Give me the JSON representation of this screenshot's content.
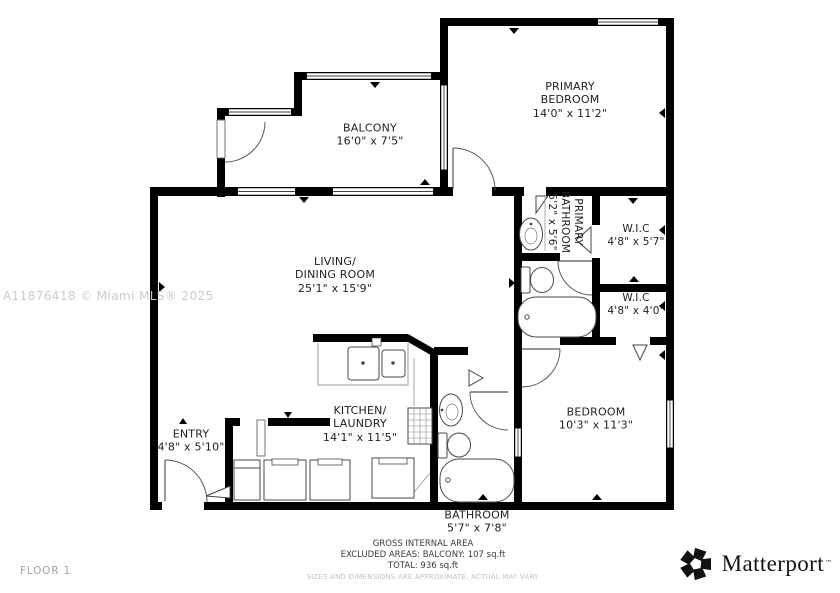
{
  "floorplan": {
    "rooms": [
      {
        "name": "PRIMARY\nBEDROOM",
        "dims": "14'0\" x 11'2\""
      },
      {
        "name": "BALCONY",
        "dims": "16'0\" x 7'5\""
      },
      {
        "name": "LIVING/\nDINING ROOM",
        "dims": "25'1\" x 15'9\""
      },
      {
        "name": "PRIMARY\nBATHROOM",
        "dims": "5'2\" x 5'6\""
      },
      {
        "name": "W.I.C",
        "dims": "4'8\" x 5'7\""
      },
      {
        "name": "W.I.C",
        "dims": "4'8\" x 4'0\""
      },
      {
        "name": "BEDROOM",
        "dims": "10'3\" x 11'3\""
      },
      {
        "name": "KITCHEN/\nLAUNDRY",
        "dims": "14'1\" x 11'5\""
      },
      {
        "name": "ENTRY",
        "dims": "4'8\" x 5'10\""
      },
      {
        "name": "BATHROOM",
        "dims": "5'7\" x 7'8\""
      }
    ],
    "floor_label": "FLOOR 1",
    "watermark": "A11876418 © Miami MLS® 2025",
    "footer": {
      "line1": "GROSS INTERNAL AREA",
      "line2": "EXCLUDED AREAS: BALCONY: 107 sq.ft",
      "line3": "TOTAL: 936 sq.ft",
      "disclaimer": "SIZES AND DIMENSIONS ARE APPROXIMATE, ACTUAL MAY VARY."
    },
    "brand": {
      "name": "Matterport",
      "trademark": "™"
    },
    "colors": {
      "wall": "#000000",
      "label": "#1f1f1f",
      "fixture": "#4a4a4a",
      "muted": "#c2c2c2"
    }
  }
}
